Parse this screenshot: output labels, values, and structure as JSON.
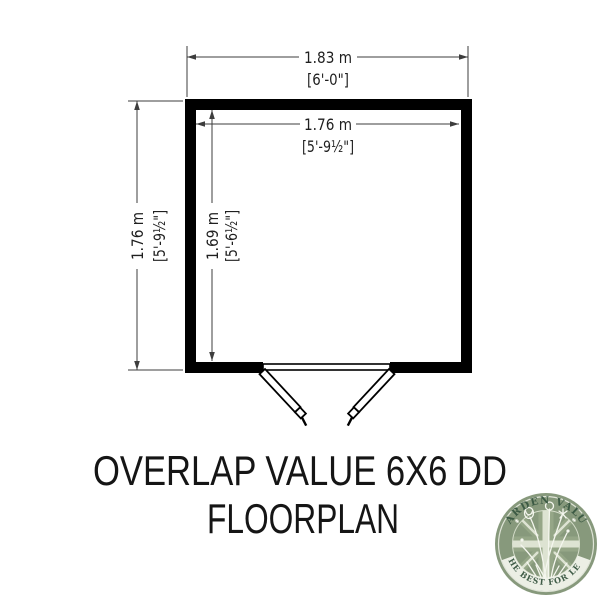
{
  "page": {
    "background_color": "#ffffff"
  },
  "floorplan": {
    "wall_color": "#000000",
    "line_color": "#3d3d3d",
    "dim_top_outer": {
      "metric": "1.83 m",
      "imperial": "[6'-0\"]"
    },
    "dim_top_inner": {
      "metric": "1.76 m",
      "imperial": "[5'-9½\"]"
    },
    "dim_left_outer": {
      "metric": "1.76 m",
      "imperial": "[5'-9½\"]"
    },
    "dim_left_inner": {
      "metric": "1.69 m",
      "imperial": "[5'-6½\"]"
    },
    "door_type": "double-door"
  },
  "title": {
    "line1": "OVERLAP VALUE 6X6 DD",
    "line2": "FLOORPLAN"
  },
  "logo": {
    "arc_top": "GARDEN VALUE",
    "arc_bottom": "THE BEST FOR LESS",
    "badge_color": "#87997c",
    "pale_color": "#dde3d2",
    "text_color": "#3c5a44"
  }
}
